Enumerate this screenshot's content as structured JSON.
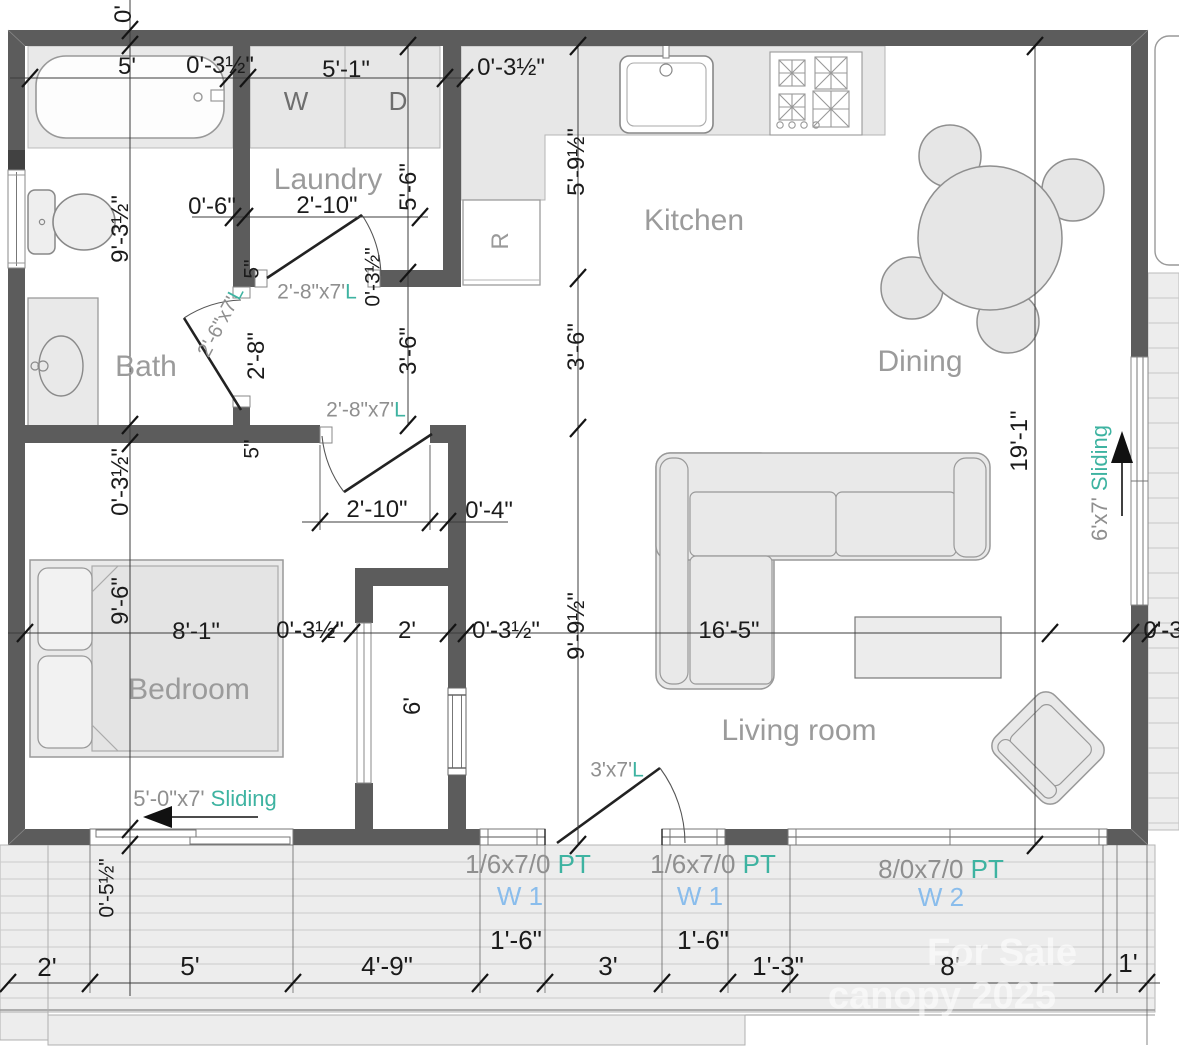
{
  "colors": {
    "wall": "#5c5c5c",
    "accent_teal": "#3eb3a1",
    "accent_blue": "#8abdec",
    "label_gray": "#9b9b9b"
  },
  "rooms": {
    "laundry": "Laundry",
    "kitchen": "Kitchen",
    "bath": "Bath",
    "dining": "Dining",
    "bedroom": "Bedroom",
    "living": "Living room"
  },
  "appliances": {
    "washer": "W",
    "dryer": "D",
    "fridge": "R"
  },
  "doors": {
    "suffix": "L",
    "laundry": "2'-8\"x7'",
    "bath": "2'-6\"x7'",
    "hall": "2'-8\"x7'",
    "front": "3'x7'"
  },
  "sliding": {
    "bedroom_size": "5'-0\"x7'",
    "patio_size": "6'x7'",
    "word": "Sliding"
  },
  "openings": {
    "w1_size": "1/6x7/0",
    "w2_size": "8/0x7/0",
    "pt": "PT",
    "w1_name": "W 1",
    "w2_name": "W 2"
  },
  "dims": {
    "top_zero": "0'",
    "tub_w": "5'",
    "wall_a": "0'-3½\"",
    "laundry_w": "5'-1\"",
    "wall_b": "0'-3½\"",
    "laundry_h": "5'-6\"",
    "kitchen_counter_h": "5'-9½\"",
    "laundry_offset": "0'-6\"",
    "laundry_door_w": "2'-10\"",
    "stub_a": "5\"",
    "wall_rot_a": "0'-3½\"",
    "bath_door_h": "2'-8\"",
    "bath_h": "9'-3½\"",
    "hall_a": "3'-6\"",
    "hall_b": "3'-6\"",
    "dining_h": "19'-1\"",
    "stub_b": "5\"",
    "hall_door_w": "2'-10\"",
    "hall_gap": "0'-4\"",
    "left_wall": "0'-3½\"",
    "bed_h": "9'-6\"",
    "bed_w": "8'-1\"",
    "closet_wall_a": "0'-3½\"",
    "closet_w": "2'",
    "closet_wall_b": "0'-3½\"",
    "living_h": "9'-9½\"",
    "living_w": "16'-5\"",
    "right_wall": "0'-3",
    "closet_h": "6'",
    "deck_step": "0'-5½\"",
    "b1": "2'",
    "b2": "5'",
    "b3": "4'-9\"",
    "b4": "1'-6\"",
    "b5": "3'",
    "b6": "1'-6\"",
    "b7": "1'-3\"",
    "b8": "8'",
    "b9": "1'"
  },
  "watermark": {
    "line1": "For Sale",
    "line2": "canopy 2025"
  }
}
